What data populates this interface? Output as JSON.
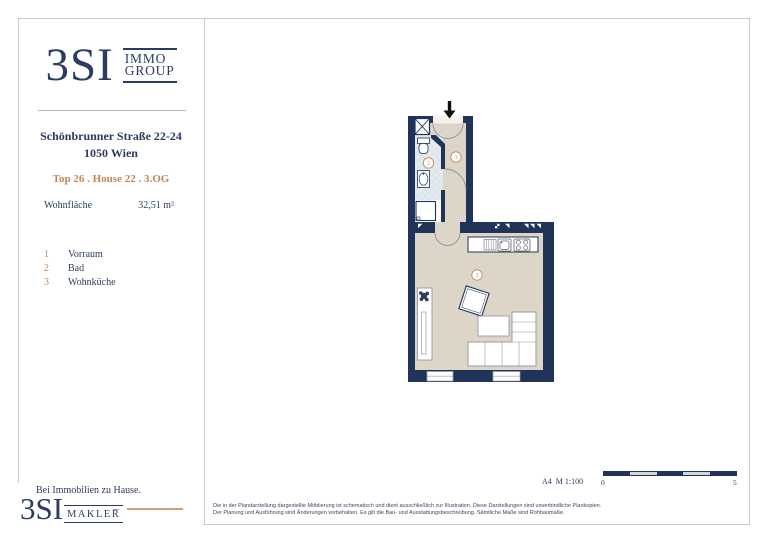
{
  "header": {
    "brand": "3SI",
    "sub1": "IMMO",
    "sub2": "GROUP"
  },
  "info": {
    "address_line1": "Schönbrunner Straße 22-24",
    "address_line2": "1050 Wien",
    "unit_line": "Top 26 . House 22 . 3.OG",
    "area_label": "Wohnfläche",
    "area_value": "32,51 m²",
    "rooms": [
      {
        "num": "1",
        "name": "Vorraum"
      },
      {
        "num": "2",
        "name": "Bad"
      },
      {
        "num": "3",
        "name": "Wohnküche"
      }
    ]
  },
  "plan": {
    "room_labels": {
      "r1": "1",
      "r2": "2",
      "r3": "3"
    }
  },
  "footer": {
    "tagline": "Bei Immobilien zu Hause.",
    "brand": "3SI",
    "brand_sub": "MAKLER",
    "disclaimer": "Die in der Plandarstellung dargestellte Möblierung ist schematisch und dient ausschließlich zur Illustration. Diese Darstellungen sind unverbindliche Plankopien. Der Planung und Ausführung sind Änderungen vorbehalten. Es gilt die Bau- und Ausstattungsbeschreibung. Sämtliche Maße sind Rohbaumaße.",
    "scale_label": "A4  M 1:100",
    "scale_start": "0",
    "scale_end": "5"
  },
  "colors": {
    "navy": "#2b3c63",
    "wall": "#20345a",
    "accent": "#bf8756",
    "floor_beige": "#ddd6c8",
    "floor_tile": "#e3ebef"
  }
}
